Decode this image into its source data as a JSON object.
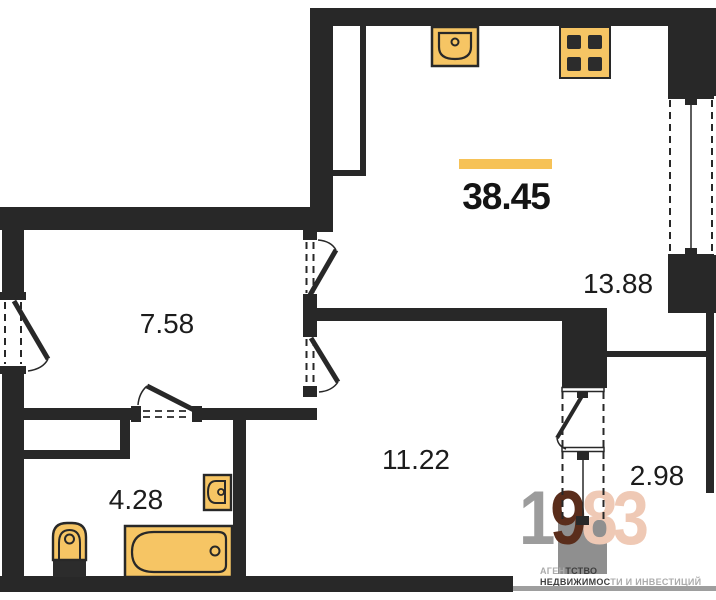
{
  "plan": {
    "total_area": "38.45",
    "rooms": [
      {
        "name": "kitchen-living-room",
        "area": "13.88"
      },
      {
        "name": "hallway",
        "area": "7.58"
      },
      {
        "name": "room",
        "area": "11.22"
      },
      {
        "name": "bathroom",
        "area": "4.28"
      },
      {
        "name": "balcony",
        "area": "2.98"
      }
    ],
    "fixtures": [
      {
        "icon": "kitchen-sink-icon"
      },
      {
        "icon": "stove-icon"
      },
      {
        "icon": "toilet-icon"
      },
      {
        "icon": "bathtub-icon"
      },
      {
        "icon": "washbasin-icon"
      }
    ]
  },
  "logo": {
    "digit_1": "1",
    "digit_9": "9",
    "digits_83": "83",
    "tagline_line1_light": "АГЕН",
    "tagline_line1_dark": "ТСТВО",
    "tagline_line2_dark": "НЕДВИЖИМОС",
    "tagline_line2_light": "ТИ И ИНВЕСТИЦИЙ"
  },
  "colors": {
    "wall": "#282828",
    "fixture_fill": "#F6C564",
    "accent_bar": "#F6C257",
    "logo_gray": "#9C9C9C",
    "logo_square": "#8F8F8F",
    "logo_brown": "#5A2D1B",
    "logo_salmon": "#EFC9B5"
  }
}
